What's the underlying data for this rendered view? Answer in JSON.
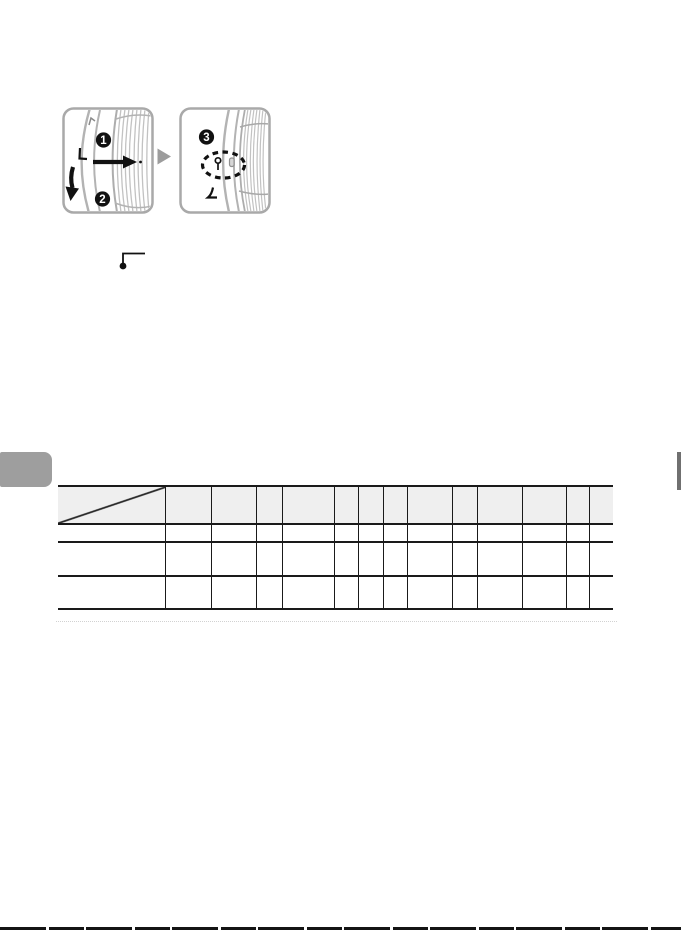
{
  "figure": {
    "callouts": [
      "1",
      "2",
      "3"
    ]
  },
  "colors": {
    "panel_border": "#a9a9a9",
    "lens_line": "#b3b3b3",
    "callout_badge": "#111111",
    "step_arrow": "#9c9c9c",
    "table_line": "#1a1a1a",
    "table_header_bg": "#efefef",
    "left_edge_tab": "#9e9e9e",
    "right_edge_tab": "#707070",
    "bottom_scan_line": "#141414"
  },
  "table": {
    "columns": 14,
    "header_cells": [
      "",
      "",
      "",
      "",
      "",
      "",
      "",
      "",
      "",
      "",
      "",
      "",
      "",
      ""
    ],
    "rows": [
      [
        "",
        "",
        "",
        "",
        "",
        "",
        "",
        "",
        "",
        "",
        "",
        "",
        "",
        ""
      ],
      [
        "",
        "",
        "",
        "",
        "",
        "",
        "",
        "",
        "",
        "",
        "",
        "",
        "",
        ""
      ],
      [
        "",
        "",
        "",
        "",
        "",
        "",
        "",
        "",
        "",
        "",
        "",
        "",
        "",
        ""
      ]
    ]
  }
}
